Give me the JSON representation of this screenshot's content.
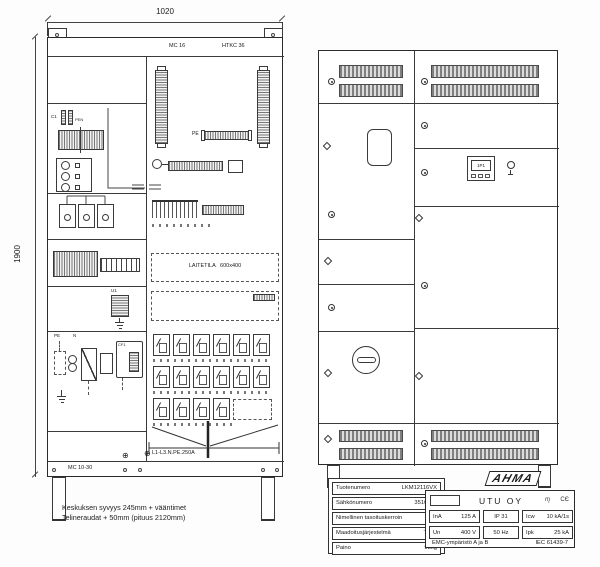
{
  "drawing": {
    "dim_width": "1020",
    "dim_height": "1900",
    "rear_view": {
      "label_mc16": "MC 16",
      "label_htkc36": "HTKC 36",
      "label_pe": "PE",
      "label_c1": "C1",
      "label_pen": "PEN",
      "label_u1": "U1",
      "label_cf1": "CF1",
      "label_pe_small": "PE",
      "label_n_small": "N",
      "label_laitetila": "LAITETILA   600x400",
      "label_cable": "L1-L3.N.PE.250A",
      "label_mc1030": "MC 10-30",
      "earth_glyph": "⊕"
    },
    "front_view": {
      "display_label": "1P1"
    },
    "notes": [
      "Keskuksen syvyys 245mm + vääntimet",
      "Telineraudat + 50mm (pituus 2120mm)"
    ]
  },
  "info_table": {
    "rows": [
      {
        "label": "Tuotenumero",
        "value": "LKM12116VX"
      },
      {
        "label": "Sähkönumero",
        "value": "3510754"
      },
      {
        "label": "Nimellinen tasoituskerroin",
        "value": "1"
      },
      {
        "label": "Maadoitusjärjestelmä",
        "value": "TN-S"
      },
      {
        "label": "Paino",
        "value": "98kg"
      }
    ]
  },
  "rating_plate": {
    "brand": "AHMA",
    "company": "UTU OY",
    "marks": {
      "cert_glyph": "ɱ",
      "ce_glyph": "CЄ"
    },
    "row1": [
      {
        "label": "InA",
        "value": "125 A"
      },
      {
        "label": "IP 31",
        "value": ""
      },
      {
        "label": "Icw",
        "value": "10 kA/1s"
      }
    ],
    "row2": [
      {
        "label": "Un",
        "value": "400 V"
      },
      {
        "label": "50 Hz",
        "value": ""
      },
      {
        "label": "Ipk",
        "value": "25 kA"
      }
    ],
    "footer_left": "EMC-ympäristö A ja B",
    "footer_right": "IEC 61439-7"
  }
}
